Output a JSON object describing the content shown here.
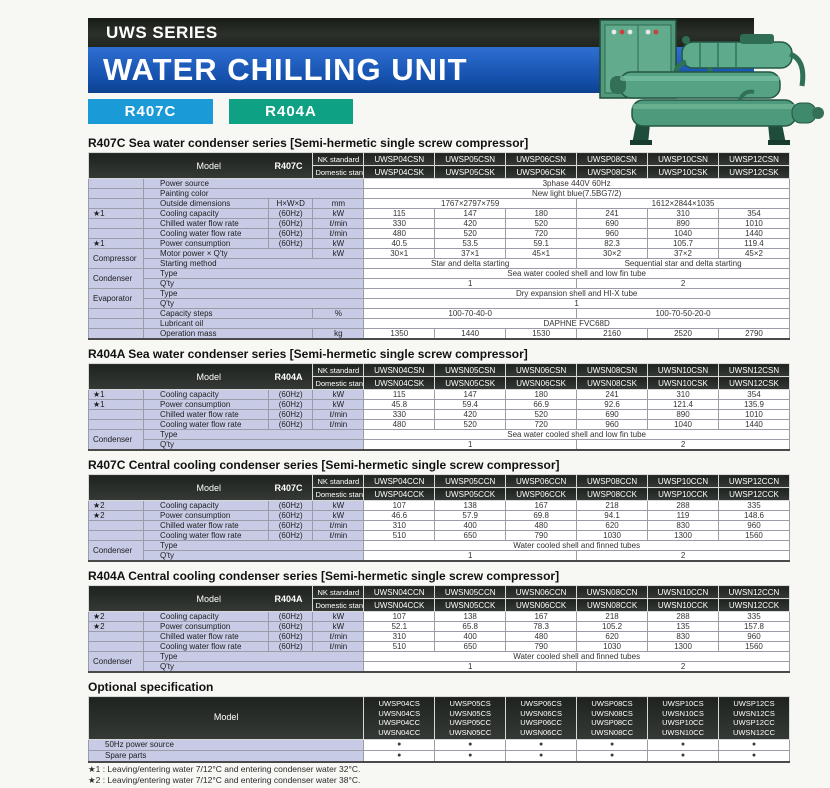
{
  "header": {
    "series": "UWS SERIES",
    "title": "WATER CHILLING UNIT",
    "badges": [
      {
        "label": "R407C",
        "color": "#1b9ad8"
      },
      {
        "label": "R404A",
        "color": "#0fa184"
      }
    ]
  },
  "colors": {
    "banner_black": "#20251e",
    "banner_blue": "#1450ab",
    "label_lavender": "#c7cbe6",
    "header_dark": "#2b2f2b",
    "machine_green": "#52987b"
  },
  "bracket_open": "[",
  "bracket_close": "]",
  "spec_tables": [
    {
      "title": "R407C Sea water condenser series",
      "bracket": "Semi-hermetic single screw compressor",
      "model_label": "Model",
      "model_code": "R407C",
      "nk_label": "NK standard",
      "dom_label": "Domestic standard",
      "models_nk": [
        "UWSP04CSN",
        "UWSP05CSN",
        "UWSP06CSN",
        "UWSP08CSN",
        "UWSP10CSN",
        "UWSP12CSN"
      ],
      "models_dom": [
        "UWSP04CSK",
        "UWSP05CSK",
        "UWSP06CSK",
        "UWSP08CSK",
        "UWSP10CSK",
        "UWSP12CSK"
      ],
      "rows": [
        {
          "label": "Power source",
          "cells": [
            {
              "t": "3phase 440V  60Hz",
              "s": 6
            }
          ]
        },
        {
          "label": "Painting color",
          "cells": [
            {
              "t": "New light blue(7.5BG7/2)",
              "s": 6
            }
          ]
        },
        {
          "label": "Outside dimensions",
          "sub": "H×W×D",
          "unit": "mm",
          "cells": [
            {
              "t": "1767×2797×759",
              "s": 3
            },
            {
              "t": "1612×2844×1035",
              "s": 3
            }
          ]
        },
        {
          "g": "★1",
          "label": "Cooling capacity",
          "sub": "(60Hz)",
          "unit": "kW",
          "cells": [
            "115",
            "147",
            "180",
            "241",
            "310",
            "354"
          ]
        },
        {
          "label": "Chilled water flow rate",
          "sub": "(60Hz)",
          "unit": "ℓ/min",
          "cells": [
            "330",
            "420",
            "520",
            "690",
            "890",
            "1010"
          ]
        },
        {
          "label": "Cooling water flow rate",
          "sub": "(60Hz)",
          "unit": "ℓ/min",
          "cells": [
            "480",
            "520",
            "720",
            "960",
            "1040",
            "1440"
          ]
        },
        {
          "g": "★1",
          "label": "Power consumption",
          "sub": "(60Hz)",
          "unit": "kW",
          "cells": [
            "40.5",
            "53.5",
            "59.1",
            "82.3",
            "105.7",
            "119.4"
          ]
        },
        {
          "g": "Compressor",
          "gspan": 2,
          "label": "Motor power × Q'ty",
          "unit": "kW",
          "cells": [
            "30×1",
            "37×1",
            "45×1",
            "30×2",
            "37×2",
            "45×2"
          ]
        },
        {
          "gskip": true,
          "label": "Starting method",
          "cells": [
            {
              "t": "Star and delta starting",
              "s": 3
            },
            {
              "t": "Sequential star and delta starting",
              "s": 3
            }
          ]
        },
        {
          "g": "Condenser",
          "gspan": 2,
          "label": "Type",
          "cells": [
            {
              "t": "Sea water cooled shell and low fin tube",
              "s": 6
            }
          ]
        },
        {
          "gskip": true,
          "label": "Q'ty",
          "cells": [
            {
              "t": "1",
              "s": 3
            },
            {
              "t": "2",
              "s": 3
            }
          ]
        },
        {
          "g": "Evaporator",
          "gspan": 2,
          "label": "Type",
          "cells": [
            {
              "t": "Dry expansion shell and HI-X tube",
              "s": 6
            }
          ]
        },
        {
          "gskip": true,
          "label": "Q'ty",
          "cells": [
            {
              "t": "1",
              "s": 6
            }
          ]
        },
        {
          "label": "Capacity steps",
          "unit": "%",
          "cells": [
            {
              "t": "100-70-40-0",
              "s": 3
            },
            {
              "t": "100-70-50-20-0",
              "s": 3
            }
          ]
        },
        {
          "label": "Lubricant oil",
          "cells": [
            {
              "t": "DAPHNE FVC68D",
              "s": 6
            }
          ]
        },
        {
          "label": "Operation mass",
          "unit": "kg",
          "cells": [
            "1350",
            "1440",
            "1530",
            "2160",
            "2520",
            "2790"
          ]
        }
      ]
    },
    {
      "title": "R404A Sea water condenser series",
      "bracket": "Semi-hermetic single screw compressor",
      "model_label": "Model",
      "model_code": "R404A",
      "nk_label": "NK standard",
      "dom_label": "Domestic standard",
      "models_nk": [
        "UWSN04CSN",
        "UWSN05CSN",
        "UWSN06CSN",
        "UWSN08CSN",
        "UWSN10CSN",
        "UWSN12CSN"
      ],
      "models_dom": [
        "UWSN04CSK",
        "UWSN05CSK",
        "UWSN06CSK",
        "UWSN08CSK",
        "UWSN10CSK",
        "UWSN12CSK"
      ],
      "rows": [
        {
          "g": "★1",
          "label": "Cooling capacity",
          "sub": "(60Hz)",
          "unit": "kW",
          "cells": [
            "115",
            "147",
            "180",
            "241",
            "310",
            "354"
          ]
        },
        {
          "g": "★1",
          "label": "Power consumption",
          "sub": "(60Hz)",
          "unit": "kW",
          "cells": [
            "45.8",
            "59.4",
            "66.9",
            "92.6",
            "121.4",
            "135.9"
          ]
        },
        {
          "label": "Chilled water flow rate",
          "sub": "(60Hz)",
          "unit": "ℓ/min",
          "cells": [
            "330",
            "420",
            "520",
            "690",
            "890",
            "1010"
          ]
        },
        {
          "label": "Cooling water flow rate",
          "sub": "(60Hz)",
          "unit": "ℓ/min",
          "cells": [
            "480",
            "520",
            "720",
            "960",
            "1040",
            "1440"
          ]
        },
        {
          "g": "Condenser",
          "gspan": 2,
          "label": "Type",
          "cells": [
            {
              "t": "Sea water cooled shell and low fin tube",
              "s": 6
            }
          ]
        },
        {
          "gskip": true,
          "label": "Q'ty",
          "cells": [
            {
              "t": "1",
              "s": 3
            },
            {
              "t": "2",
              "s": 3
            }
          ]
        }
      ]
    },
    {
      "title": "R407C Central cooling condenser series",
      "bracket": "Semi-hermetic single screw compressor",
      "model_label": "Model",
      "model_code": "R407C",
      "nk_label": "NK standard",
      "dom_label": "Domestic standard",
      "models_nk": [
        "UWSP04CCN",
        "UWSP05CCN",
        "UWSP06CCN",
        "UWSP08CCN",
        "UWSP10CCN",
        "UWSP12CCN"
      ],
      "models_dom": [
        "UWSP04CCK",
        "UWSP05CCK",
        "UWSP06CCK",
        "UWSP08CCK",
        "UWSP10CCK",
        "UWSP12CCK"
      ],
      "rows": [
        {
          "g": "★2",
          "label": "Cooling capacity",
          "sub": "(60Hz)",
          "unit": "kW",
          "cells": [
            "107",
            "138",
            "167",
            "218",
            "288",
            "335"
          ]
        },
        {
          "g": "★2",
          "label": "Power consumption",
          "sub": "(60Hz)",
          "unit": "kW",
          "cells": [
            "46.6",
            "57.9",
            "69.8",
            "94.1",
            "119",
            "148.6"
          ]
        },
        {
          "label": "Chilled water flow rate",
          "sub": "(60Hz)",
          "unit": "ℓ/min",
          "cells": [
            "310",
            "400",
            "480",
            "620",
            "830",
            "960"
          ]
        },
        {
          "label": "Cooling water flow rate",
          "sub": "(60Hz)",
          "unit": "ℓ/min",
          "cells": [
            "510",
            "650",
            "790",
            "1030",
            "1300",
            "1560"
          ]
        },
        {
          "g": "Condenser",
          "gspan": 2,
          "label": "Type",
          "cells": [
            {
              "t": "Water cooled shell and finned tubes",
              "s": 6
            }
          ]
        },
        {
          "gskip": true,
          "label": "Q'ty",
          "cells": [
            {
              "t": "1",
              "s": 3
            },
            {
              "t": "2",
              "s": 3
            }
          ]
        }
      ]
    },
    {
      "title": "R404A Central cooling condenser series",
      "bracket": "Semi-hermetic single screw compressor",
      "model_label": "Model",
      "model_code": "R404A",
      "nk_label": "NK standard",
      "dom_label": "Domestic standard",
      "models_nk": [
        "UWSN04CCN",
        "UWSN05CCN",
        "UWSN06CCN",
        "UWSN08CCN",
        "UWSN10CCN",
        "UWSN12CCN"
      ],
      "models_dom": [
        "UWSN04CCK",
        "UWSN05CCK",
        "UWSN06CCK",
        "UWSN08CCK",
        "UWSN10CCK",
        "UWSN12CCK"
      ],
      "rows": [
        {
          "g": "★2",
          "label": "Cooling capacity",
          "sub": "(60Hz)",
          "unit": "kW",
          "cells": [
            "107",
            "138",
            "167",
            "218",
            "288",
            "335"
          ]
        },
        {
          "g": "★2",
          "label": "Power consumption",
          "sub": "(60Hz)",
          "unit": "kW",
          "cells": [
            "52.1",
            "65.8",
            "78.3",
            "105.2",
            "135",
            "157.8"
          ]
        },
        {
          "label": "Chilled water flow rate",
          "sub": "(60Hz)",
          "unit": "ℓ/min",
          "cells": [
            "310",
            "400",
            "480",
            "620",
            "830",
            "960"
          ]
        },
        {
          "label": "Cooling water flow rate",
          "sub": "(60Hz)",
          "unit": "ℓ/min",
          "cells": [
            "510",
            "650",
            "790",
            "1030",
            "1300",
            "1560"
          ]
        },
        {
          "g": "Condenser",
          "gspan": 2,
          "label": "Type",
          "cells": [
            {
              "t": "Water cooled shell and finned tubes",
              "s": 6
            }
          ]
        },
        {
          "gskip": true,
          "label": "Q'ty",
          "cells": [
            {
              "t": "1",
              "s": 3
            },
            {
              "t": "2",
              "s": 3
            }
          ]
        }
      ]
    }
  ],
  "optional": {
    "title": "Optional specification",
    "model_label": "Model",
    "columns": [
      [
        "UWSP04CS",
        "UWSN04CS",
        "UWSP04CC",
        "UWSN04CC"
      ],
      [
        "UWSP05CS",
        "UWSN05CS",
        "UWSP05CC",
        "UWSN05CC"
      ],
      [
        "UWSP06CS",
        "UWSN06CS",
        "UWSP06CC",
        "UWSN06CC"
      ],
      [
        "UWSP08CS",
        "UWSN08CS",
        "UWSP08CC",
        "UWSN08CC"
      ],
      [
        "UWSP10CS",
        "UWSN10CS",
        "UWSP10CC",
        "UWSN10CC"
      ],
      [
        "UWSP12CS",
        "UWSN12CS",
        "UWSP12CC",
        "UWSN12CC"
      ]
    ],
    "dot": "●",
    "rows": [
      {
        "label": "50Hz power source",
        "dots": [
          true,
          true,
          true,
          true,
          true,
          true
        ]
      },
      {
        "label": "Spare parts",
        "dots": [
          true,
          true,
          true,
          true,
          true,
          true
        ]
      }
    ]
  },
  "footnotes": [
    "★1 : Leaving/entering water 7/12°C and entering condenser water 32°C.",
    "★2 : Leaving/entering water 7/12°C and entering condenser water 38°C."
  ]
}
